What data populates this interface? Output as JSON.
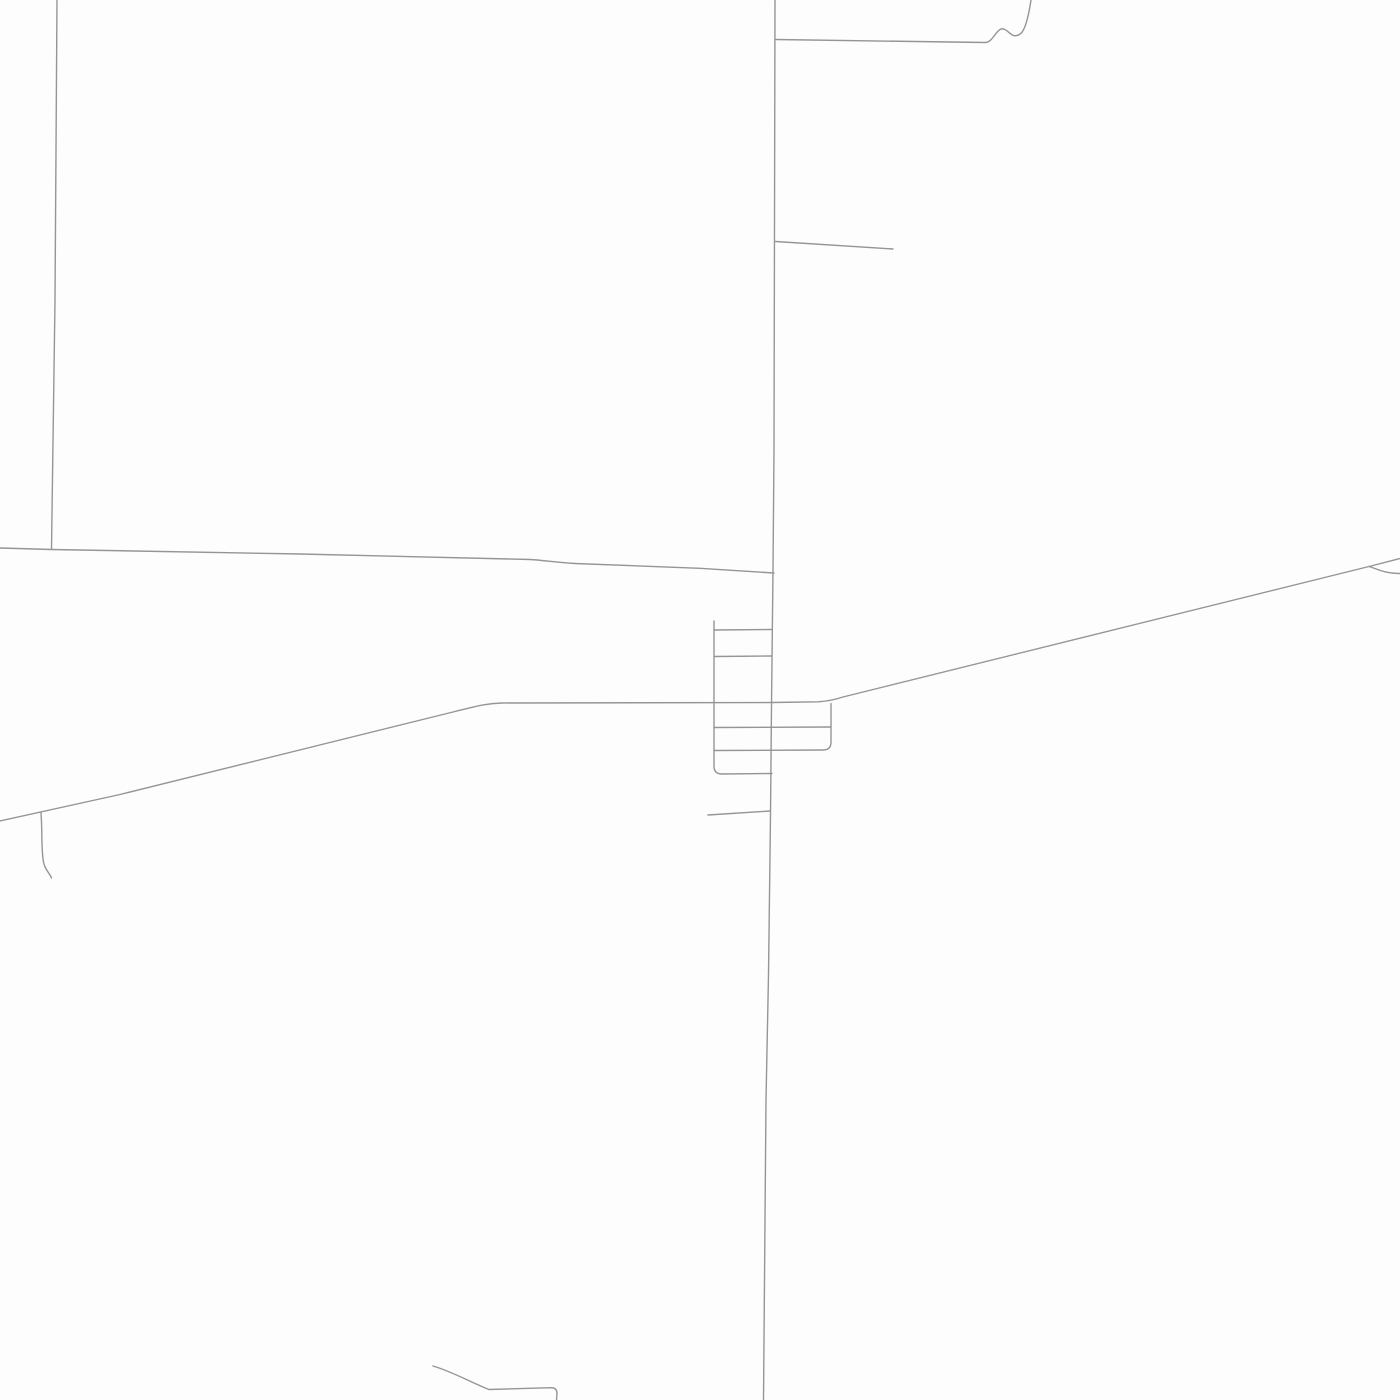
{
  "map": {
    "kind": "street-map",
    "background_color": "#fdfdfd",
    "road_color": "#959595",
    "road_width": 1.4,
    "labels": [],
    "roads": [
      {
        "name": "main-road-north-south",
        "d": "M775,0 L774,450 L773,570 L772,660 L771.5,705 L770.5,815 L768.5,975 L766,1100 L763.5,1400"
      },
      {
        "name": "northeast-road",
        "d": "M775.5,39.5 L985,42.5 C992,42.5 995,32.5 1000,29.5 C1004.5,26.8 1009,33.5 1013,35.2 C1016.5,36.8 1020.5,34.5 1022.5,31.5 C1027,24.5 1029.5,10 1031,0"
      },
      {
        "name": "east-spur-road",
        "d": "M775.5,241.5 L893,249"
      },
      {
        "name": "northwest-road-vertical",
        "d": "M57,0 L55,300 L51.5,549"
      },
      {
        "name": "west-road-horizontal",
        "d": "M0,548 L51.5,549.5 L300,554 L530,559.5 C545,560.5 558,562.5 575,563.5 L700,568.3 L774,573"
      },
      {
        "name": "southwest-diagonal-road",
        "d": "M0,821 L120,794.5 L455,711.5 C478,705.8 487,703.3 502,703 L772,702.5 L818,701.8 C828,701.3 836,699.3 843,697 L1371,566 L1400,558.5"
      },
      {
        "name": "east-branch-road",
        "d": "M1369,566.5 C1379,569.5 1383,573 1400,573.5"
      },
      {
        "name": "town-grid-west-street",
        "d": "M714,621 L714,766 Q714,774 722,774 L772,773.5"
      },
      {
        "name": "town-grid-street-1",
        "d": "M714,630 L772,629.5"
      },
      {
        "name": "town-grid-street-2",
        "d": "M714,656.5 L772,656"
      },
      {
        "name": "town-grid-street-3",
        "d": "M714,727.5 L831,727"
      },
      {
        "name": "town-grid-east-loop",
        "d": "M831,703.5 L831,742 Q831,750 823,750 L714,750.5"
      },
      {
        "name": "south-spur-street",
        "d": "M708,815 L770,811"
      },
      {
        "name": "west-branch-lane",
        "d": "M41,813 C42.5,832 41,848 43.5,862 C45,870 49,872 51.5,878"
      },
      {
        "name": "south-lane",
        "d": "M433,1366 C452,1371.5 470,1382 489,1389.5 L551,1387.7 Q557,1387.7 557,1393.5 L556.5,1400"
      }
    ]
  }
}
